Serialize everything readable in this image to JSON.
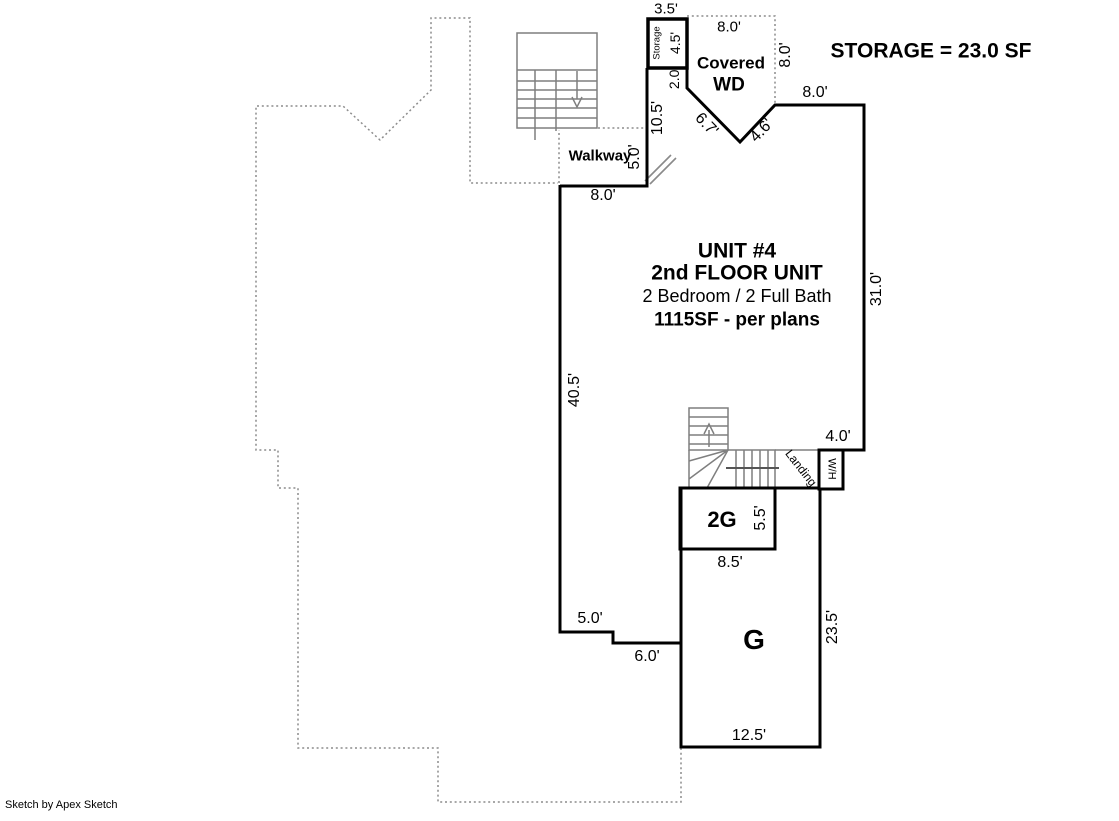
{
  "footer": {
    "credit": "Sketch by Apex Sketch"
  },
  "annotations": {
    "storage_summary": "STORAGE = 23.0 SF"
  },
  "storage_box": {
    "label": "Storage",
    "dim_width": "3.5'",
    "dim_height": "4.5'"
  },
  "covered_porch": {
    "name_line1": "Covered",
    "name_line2": "WD",
    "dim_top": "8.0'",
    "dim_right": "8.0'",
    "dim_left": "2.0'",
    "dim_diag_left": "6.7'",
    "dim_diag_right": "4.6'"
  },
  "walkway": {
    "label": "Walkway",
    "dim_width": "5.0'",
    "dim_bottom": "8.0'",
    "dim_side_wall": "10.5'"
  },
  "unit": {
    "title": "UNIT #4",
    "floor": "2nd FLOOR UNIT",
    "rooms": "2 Bedroom / 2 Full Bath",
    "area": "1115SF - per plans",
    "dim_top": "8.0'",
    "dim_right": "31.0'",
    "dim_left": "40.5'",
    "dim_notch": "4.0'",
    "dim_step_a": "5.0'",
    "dim_step_b": "6.0'"
  },
  "landing": {
    "label": "Landing",
    "water_heater": "W/H"
  },
  "garage_upper": {
    "label": "2G",
    "dim_height": "5.5'",
    "dim_width": "8.5'"
  },
  "garage": {
    "label": "G",
    "dim_right": "23.5'",
    "dim_bottom": "12.5'"
  },
  "colors": {
    "wall": "#000000",
    "stairs": "#7f7f7f",
    "dashed_outline": "#8c8c8c",
    "background": "#ffffff"
  }
}
